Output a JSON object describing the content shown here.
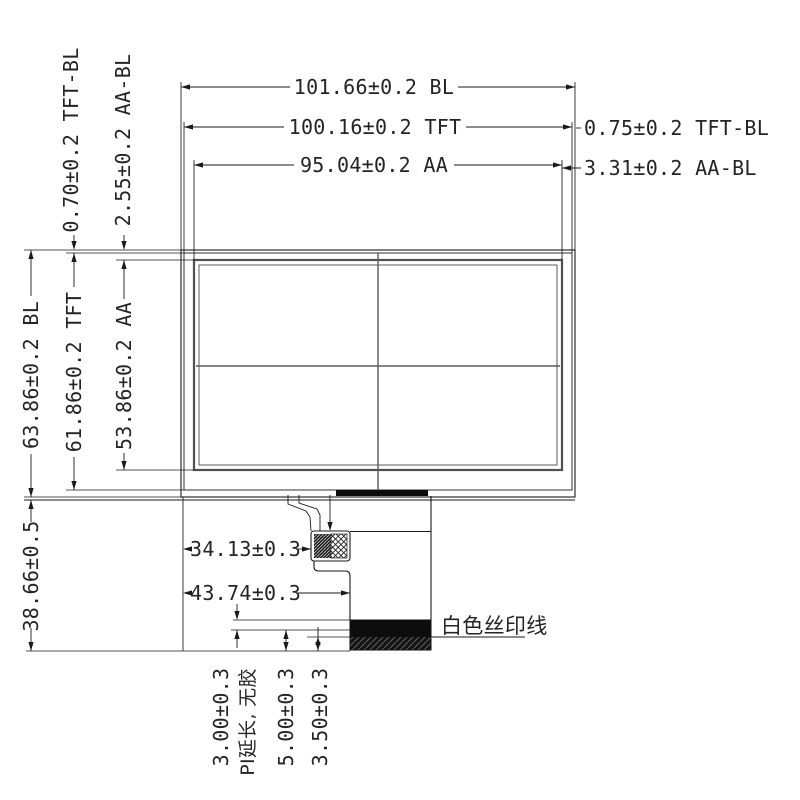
{
  "colors": {
    "line": "#1a1a1a",
    "aa_border": "#4f4f4f",
    "centerline": "#5a5a5a",
    "text": "#242424",
    "fill_dark": "#0d0d0d",
    "bg": "#ffffff"
  },
  "dims": {
    "bl_width": "101.66±0.2 BL",
    "tft_width": "100.16±0.2 TFT",
    "aa_width": "95.04±0.2 AA",
    "tft_bl_right": "0.75±0.2 TFT-BL",
    "aa_bl_right": "3.31±0.2 AA-BL",
    "tft_bl_top": "0.70±0.2 TFT-BL",
    "aa_bl_top": "2.55±0.2 AA-BL",
    "bl_height": "63.86±0.2 BL",
    "tft_height": "61.86±0.2 TFT",
    "aa_height": "53.86±0.2 AA",
    "total_height": "38.66±0.5",
    "connector_offset": "34.13±0.3",
    "fpc_edge_offset": "43.74±0.3",
    "pi_extension": "3.00±0.3",
    "pi_extension_note": "PI延长, 无胶",
    "contact_length": "5.00±0.3",
    "silkscreen_offset": "3.50±0.3"
  },
  "annotations": {
    "silkscreen_line": "白色丝印线"
  }
}
